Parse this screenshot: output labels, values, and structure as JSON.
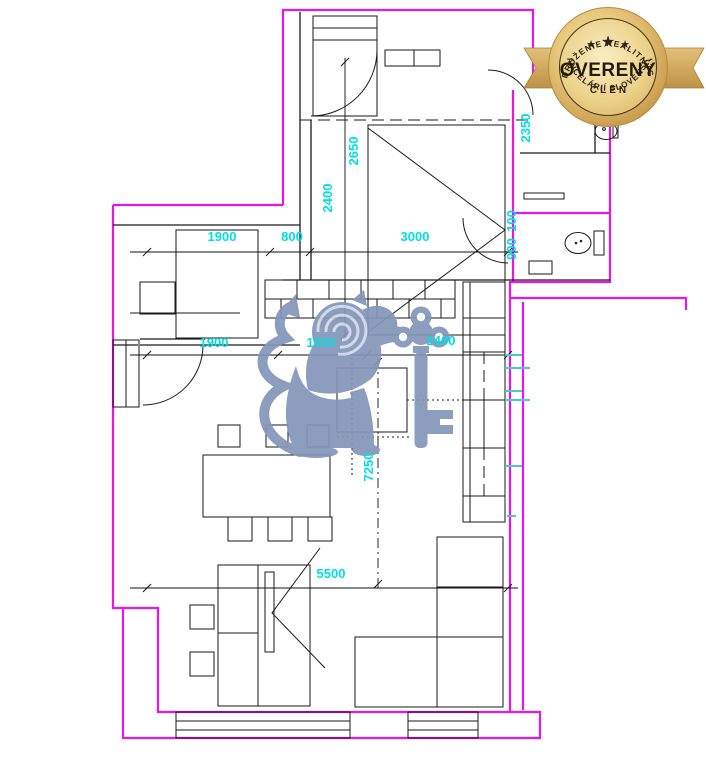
{
  "page": {
    "background": "#ffffff"
  },
  "badge": {
    "top_arc": "ZDRUŽENIE REALITNÝCH",
    "bottom_arc": "KANCELÁRIÍ SLOVENSKA",
    "title": "OVERENÝ",
    "subtitle": "ČLEN",
    "stars": [
      "★",
      "★",
      "★"
    ],
    "gold_color": "#d9b261",
    "text_color": "#2e2414"
  },
  "watermark": {
    "name": "lion-with-key",
    "color": "#8496ba"
  },
  "plan": {
    "wall_color": "#e616e6",
    "line_color": "#1a1a1a",
    "dimension_color": "#00dfe0",
    "dimensions": [
      {
        "text": "1900",
        "x": 222,
        "y": 241,
        "rot": 0
      },
      {
        "text": "800",
        "x": 292,
        "y": 241,
        "rot": 0
      },
      {
        "text": "3000",
        "x": 415,
        "y": 241,
        "rot": 0
      },
      {
        "text": "2650",
        "x": 358,
        "y": 151,
        "rot": -90
      },
      {
        "text": "2400",
        "x": 332,
        "y": 198,
        "rot": -90
      },
      {
        "text": "2350",
        "x": 530,
        "y": 128,
        "rot": -90
      },
      {
        "text": "100",
        "x": 516,
        "y": 221,
        "rot": -90
      },
      {
        "text": "900",
        "x": 516,
        "y": 249,
        "rot": -90
      },
      {
        "text": "1900",
        "x": 214,
        "y": 347,
        "rot": 0
      },
      {
        "text": "1500",
        "x": 321,
        "y": 347,
        "rot": 0
      },
      {
        "text": "2400",
        "x": 441,
        "y": 345,
        "rot": 0
      },
      {
        "text": "7250",
        "x": 373,
        "y": 467,
        "rot": -90
      },
      {
        "text": "5500",
        "x": 331,
        "y": 578,
        "rot": 0
      }
    ]
  }
}
